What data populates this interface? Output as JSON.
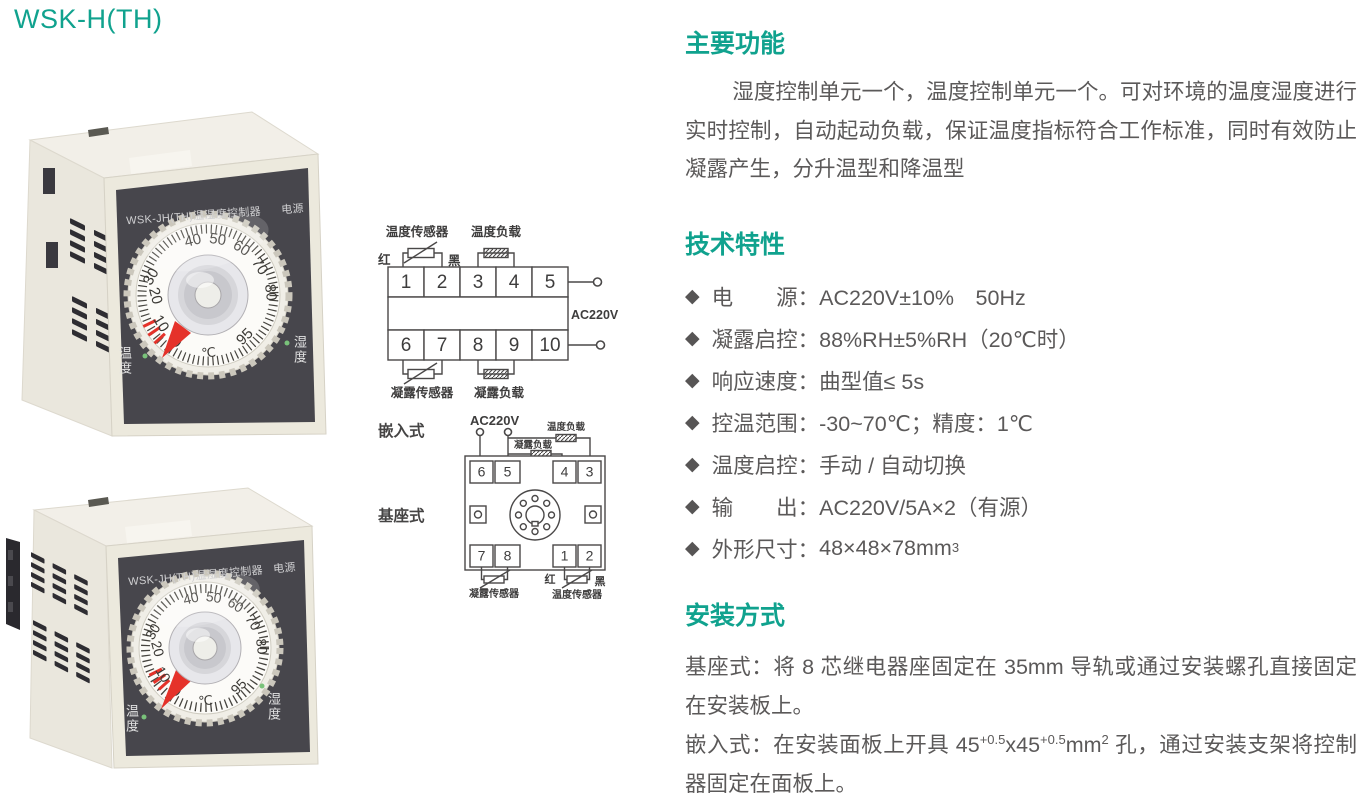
{
  "title": "WSK-H(TH)",
  "colors": {
    "accent": "#10a28e",
    "body_text": "#5b5959",
    "panel_dark": "#46454b",
    "pointer_red": "#e5322a",
    "led_green": "#79c27a"
  },
  "products": {
    "panel_title": "WSK-JH(TH)温湿度控制器",
    "power_label": "电源",
    "temp_label": "温度",
    "humidity_label": "湿度",
    "dial": {
      "numbers": [
        "40",
        "50",
        "60",
        "70",
        "80",
        "95",
        "0",
        "10",
        "20",
        "30"
      ],
      "unit": "℃"
    }
  },
  "diagrams": {
    "embedded_caption": "嵌入式",
    "base_caption": "基座式",
    "top": {
      "temp_sensor": "温度传感器",
      "temp_load": "温度负载",
      "red": "红",
      "black": "黑",
      "power": "AC220V",
      "cond_sensor": "凝露传感器",
      "cond_load": "凝露负载",
      "terminals_top": [
        "1",
        "2",
        "3",
        "4",
        "5"
      ],
      "terminals_bottom": [
        "6",
        "7",
        "8",
        "9",
        "10"
      ]
    },
    "bottom": {
      "power": "AC220V",
      "temp_load": "温度负载",
      "cond_load": "凝露负载",
      "pins_top": [
        "6",
        "5",
        "4",
        "3"
      ],
      "pins_bottom": [
        "7",
        "8",
        "1",
        "2"
      ],
      "red": "红",
      "black": "黑",
      "cond_sensor": "凝露传感器",
      "temp_sensor": "温度传感器"
    }
  },
  "sections": {
    "features": {
      "heading": "主要功能",
      "body": "湿度控制单元一个，温度控制单元一个。可对环境的温度湿度进行实时控制，自动起动负载，保证温度指标符合工作标准，同时有效防止凝露产生，分升温型和降温型"
    },
    "specs": {
      "heading": "技术特性",
      "bullet": "◆",
      "items": [
        {
          "label": "电　　源：",
          "value": "AC220V±10%　50Hz"
        },
        {
          "label": "凝露启控：",
          "value": "88%RH±5%RH（20℃时）"
        },
        {
          "label": "响应速度：",
          "value": "曲型值≤ 5s"
        },
        {
          "label": "控温范围：",
          "value": "-30~70℃；精度：1℃"
        },
        {
          "label": "温度启控：",
          "value": "手动 / 自动切换"
        },
        {
          "label": "输　　出：",
          "value": "AC220V/5A×2（有源）"
        },
        {
          "label": "外形尺寸：",
          "value": "48×48×78mm",
          "sup": "3"
        }
      ]
    },
    "install": {
      "heading": "安装方式",
      "base_line": "基座式：将 8 芯继电器座固定在 35mm 导轨或通过安装螺孔直接固定在安装板上。",
      "embed": {
        "p1": "嵌入式：在安装面板上开具 45",
        "s1": "+0.5",
        "p2": "x45",
        "s2": "+0.5",
        "p3": "mm",
        "s3": "2",
        "p4": " 孔，通过安装支架将控制器固定在面板上。"
      }
    }
  }
}
